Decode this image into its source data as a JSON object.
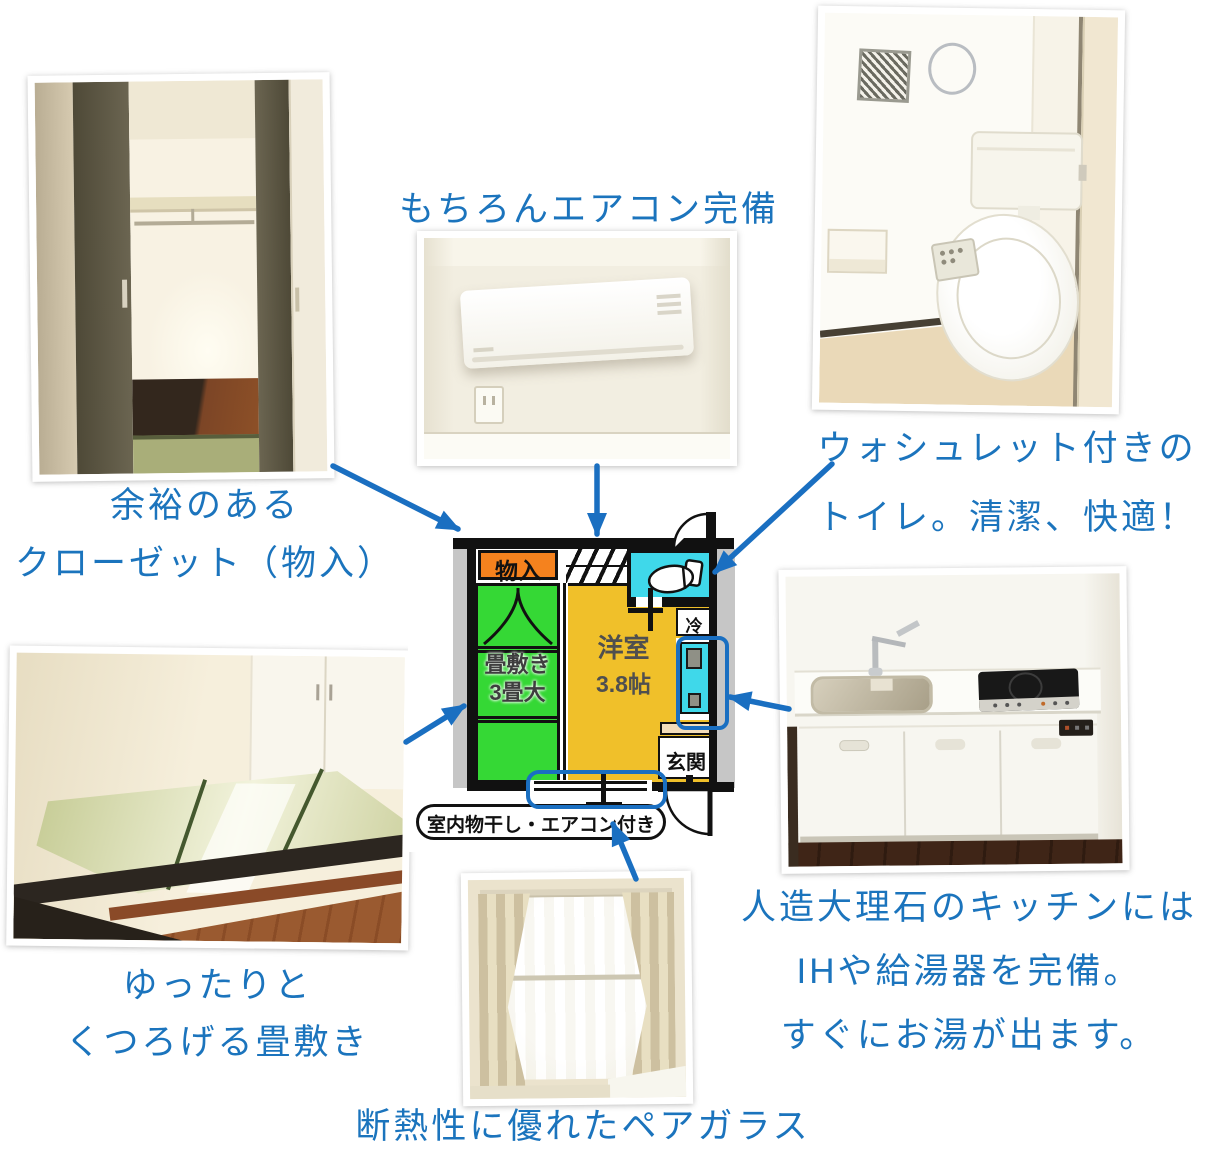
{
  "colors": {
    "caption_blue": "#1b74bd",
    "arrow_blue": "#1a6fc1",
    "plan_storage_orange": "#f5821e",
    "plan_tatami_green": "#35d835",
    "plan_room_yellow": "#f0c02a",
    "plan_water_cyan": "#3fd8ea",
    "plan_step_beige": "#f2dcba",
    "plan_wall_gray": "#c6c6c6",
    "plan_highlight_blue": "#1b6fc1"
  },
  "captions": {
    "closet": {
      "line1": "余裕のある",
      "line2": "クローゼット（物入）"
    },
    "aircon": {
      "line1": "もちろんエアコン完備"
    },
    "toilet": {
      "line1": "ウォシュレット付きの",
      "line2": "トイレ。清潔、快適！"
    },
    "tatami": {
      "line1": "ゆったりと",
      "line2": "くつろげる畳敷き"
    },
    "kitchen": {
      "line1": "人造大理石のキッチンには",
      "line2": "IHや給湯器を完備。",
      "line3": "すぐにお湯が出ます。"
    },
    "window": {
      "line1": "断熱性に優れたペアガラス"
    }
  },
  "floorplan": {
    "storage_label": "物入",
    "tatami_label_line1": "畳敷き",
    "tatami_label_line2": "3畳大",
    "room_label_line1": "洋室",
    "room_label_line2": "3.8帖",
    "fridge_label": "冷",
    "entrance_label": "玄関",
    "note_label": "室内物干し・エアコン付き"
  }
}
